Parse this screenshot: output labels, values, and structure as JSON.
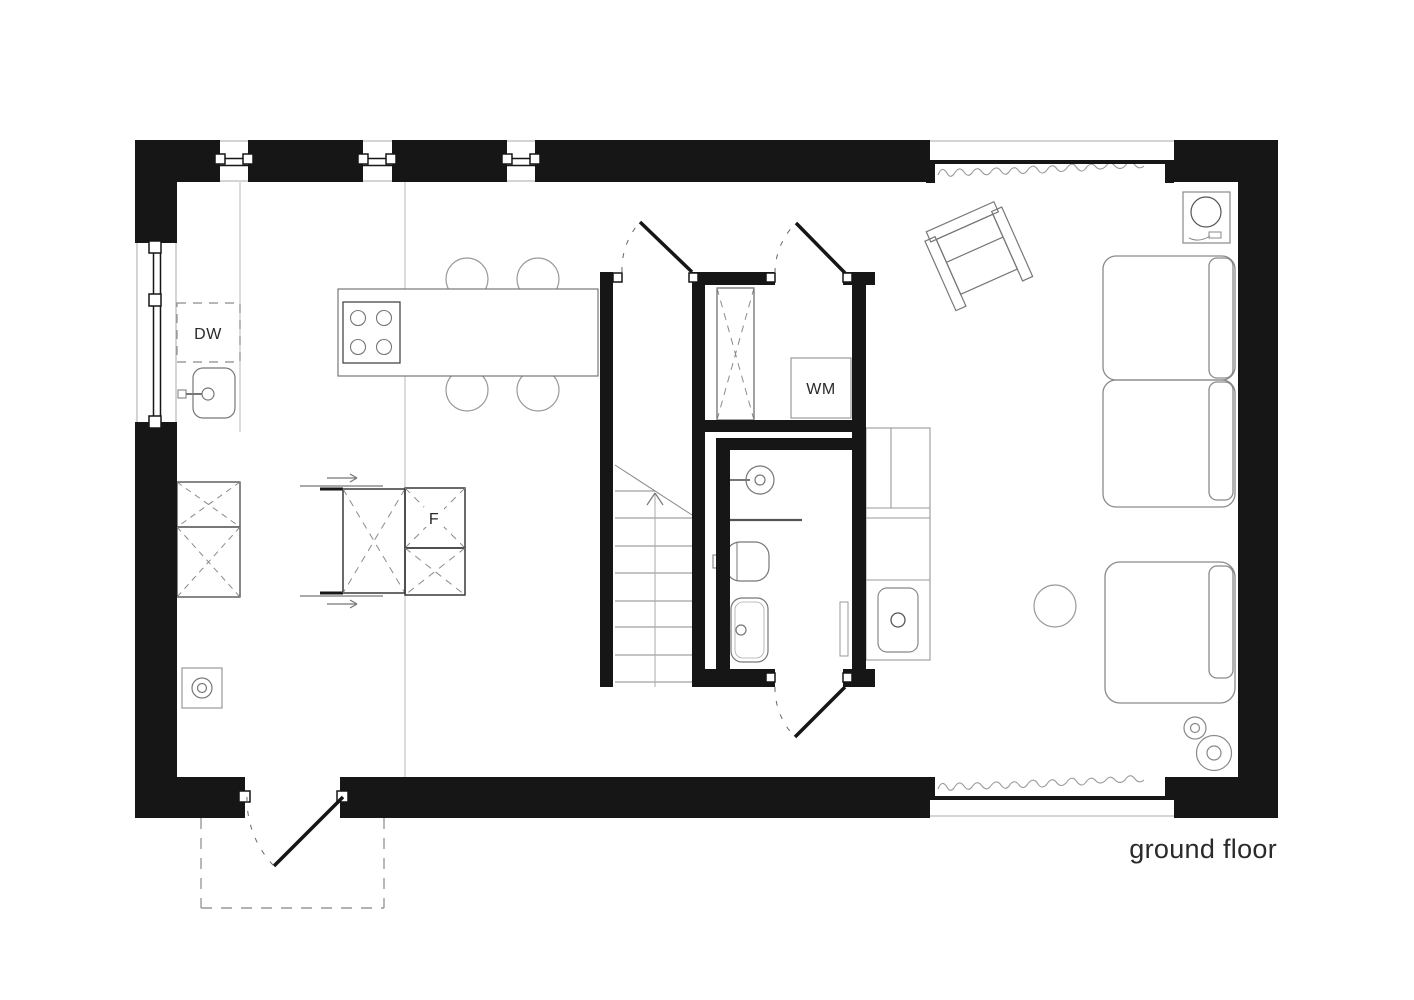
{
  "title": {
    "floor_label": "ground floor"
  },
  "labels": {
    "dishwasher": "DW",
    "washing_machine": "WM",
    "fridge": "F"
  },
  "colors": {
    "wall": "#161616",
    "furniture_line": "#8a8a8a",
    "fixture_line": "#777777",
    "floor_line": "#b8b8b8",
    "text": "#2a2a2a",
    "background": "#ffffff"
  }
}
